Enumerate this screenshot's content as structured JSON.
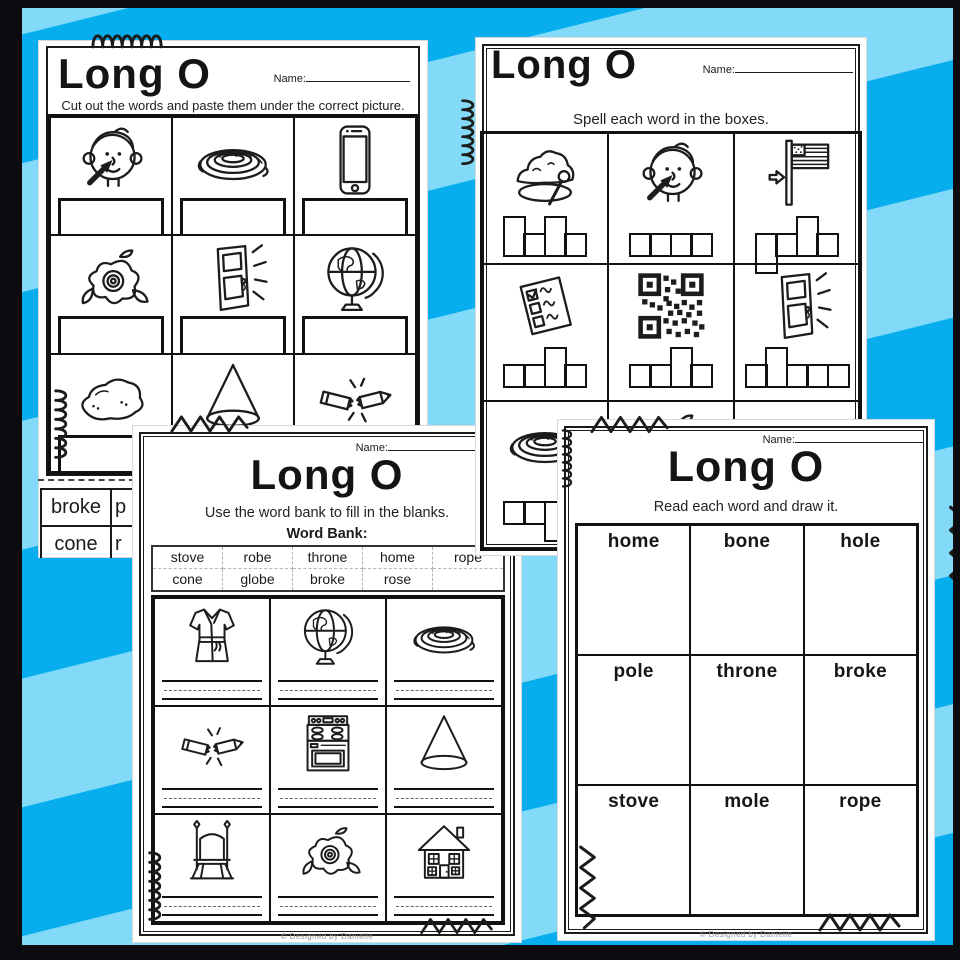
{
  "colors": {
    "stripe_dark": "#07ADEC",
    "stripe_light": "#82D9F8",
    "frame": "#0B0B10",
    "paper": "#FFFFFF",
    "ink": "#1B1B1B"
  },
  "pages": {
    "cut_paste": {
      "title": "Long O",
      "name_label": "Name:",
      "instructions": "Cut out the words and paste them under the correct picture.",
      "pictures": [
        "nose",
        "rope",
        "phone",
        "rose",
        "door-close",
        "globe",
        "stone",
        "cone",
        "broken-pencil"
      ],
      "word_cards": {
        "row1": [
          "broke",
          "p"
        ],
        "row2": [
          "cone",
          "r"
        ]
      }
    },
    "spell": {
      "title": "Long O",
      "name_label": "Name:",
      "instructions": "Spell each word in the boxes.",
      "pictures": [
        "hole",
        "nose",
        "flag-pole",
        "ballot-vote",
        "qr-code",
        "door-close",
        "rope",
        "rose",
        "broken-pencil"
      ],
      "letter_boxes": [
        "tall short tall short",
        "short short short short",
        "descender short tall short",
        "short short tall short",
        "short short tall short",
        "short tall short short short",
        "short short descender short",
        "",
        ""
      ]
    },
    "word_bank": {
      "title": "Long O",
      "name_label": "Name:",
      "instructions": "Use the word bank to fill in the blanks.",
      "bank_label": "Word Bank:",
      "bank_row1": [
        "stove",
        "robe",
        "throne",
        "home",
        "rope"
      ],
      "bank_row2": [
        "cone",
        "globe",
        "broke",
        "rose",
        ""
      ],
      "pictures": [
        "robe",
        "globe",
        "rope",
        "broken-pencil",
        "stove",
        "cone",
        "throne",
        "rose",
        "house"
      ],
      "footer": "© Designed by Danielle"
    },
    "draw": {
      "title": "Long O",
      "name_label": "Name:",
      "instructions": "Read each word and draw it.",
      "words": [
        "home",
        "bone",
        "hole",
        "pole",
        "throne",
        "broke",
        "stove",
        "mole",
        "rope"
      ],
      "footer": "© Designed by Danielle"
    }
  }
}
